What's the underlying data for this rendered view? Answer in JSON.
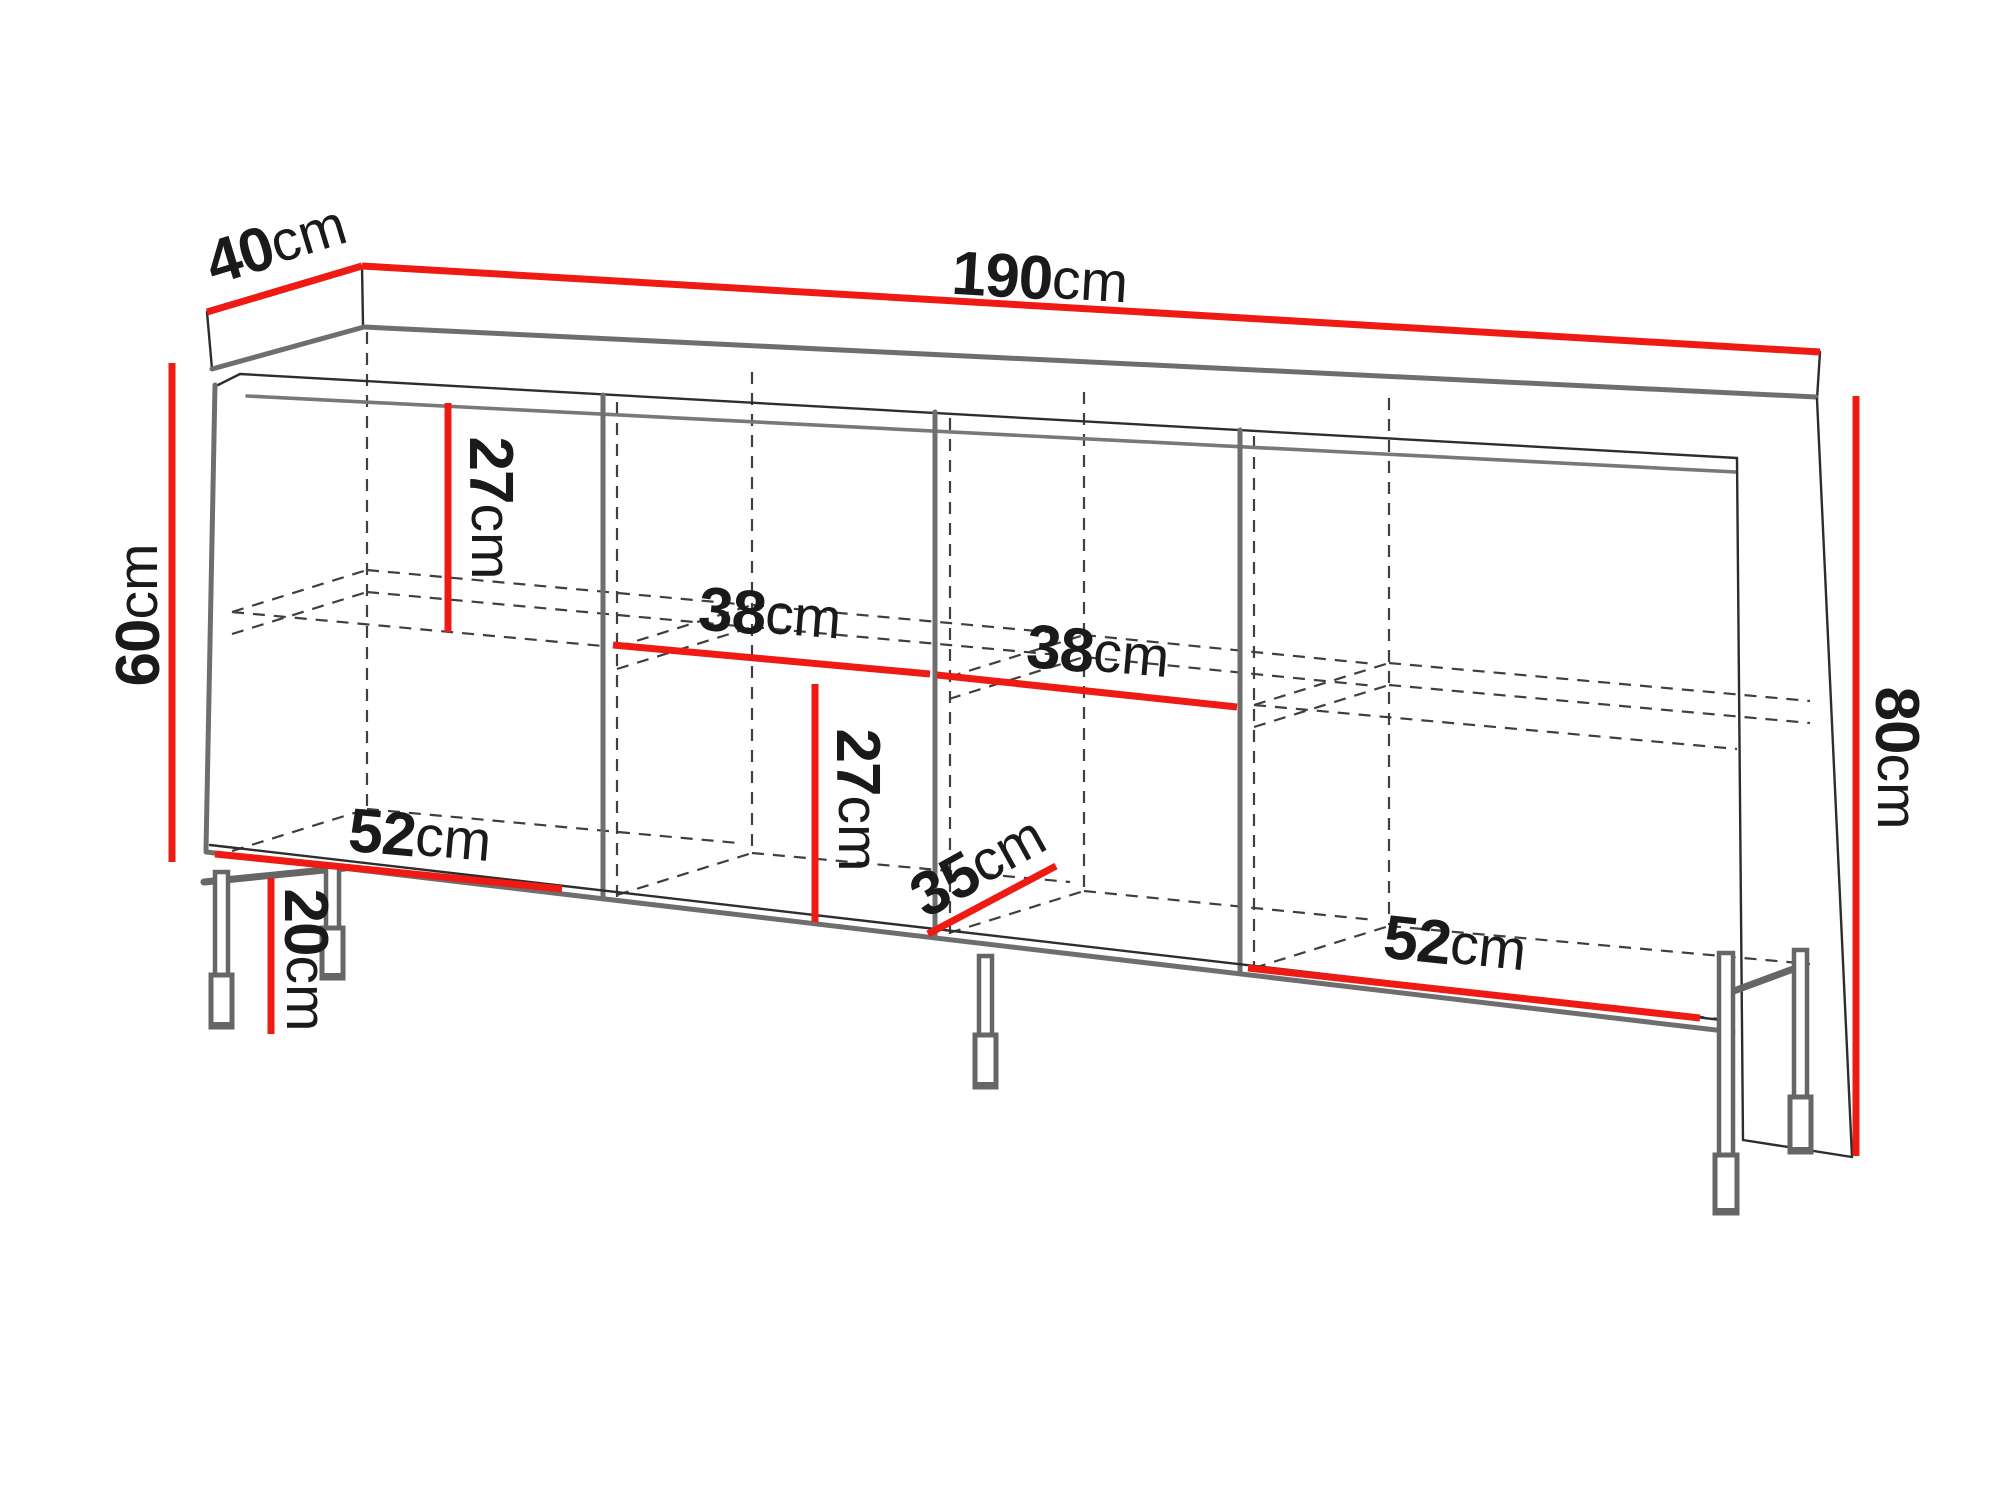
{
  "diagram": {
    "type": "furniture-dimension-drawing",
    "unit": "cm",
    "colors": {
      "dimension_line": "#ee1b14",
      "outline": "#2d2d2d",
      "panel_edge": "#6e6e6e"
    },
    "dimensions": {
      "depth_top": {
        "num": "40",
        "unit": "cm"
      },
      "width_top": {
        "num": "190",
        "unit": "cm"
      },
      "height_left_body": {
        "num": "60",
        "unit": "cm"
      },
      "height_right_total": {
        "num": "80",
        "unit": "cm"
      },
      "upper_inner_height": {
        "num": "27",
        "unit": "cm"
      },
      "inner_width_left": {
        "num": "38",
        "unit": "cm"
      },
      "inner_width_right": {
        "num": "38",
        "unit": "cm"
      },
      "lower_inner_height": {
        "num": "27",
        "unit": "cm"
      },
      "inner_depth": {
        "num": "35",
        "unit": "cm"
      },
      "bottom_width_left": {
        "num": "52",
        "unit": "cm"
      },
      "leg_height": {
        "num": "20",
        "unit": "cm"
      },
      "bottom_width_right": {
        "num": "52",
        "unit": "cm"
      }
    }
  }
}
